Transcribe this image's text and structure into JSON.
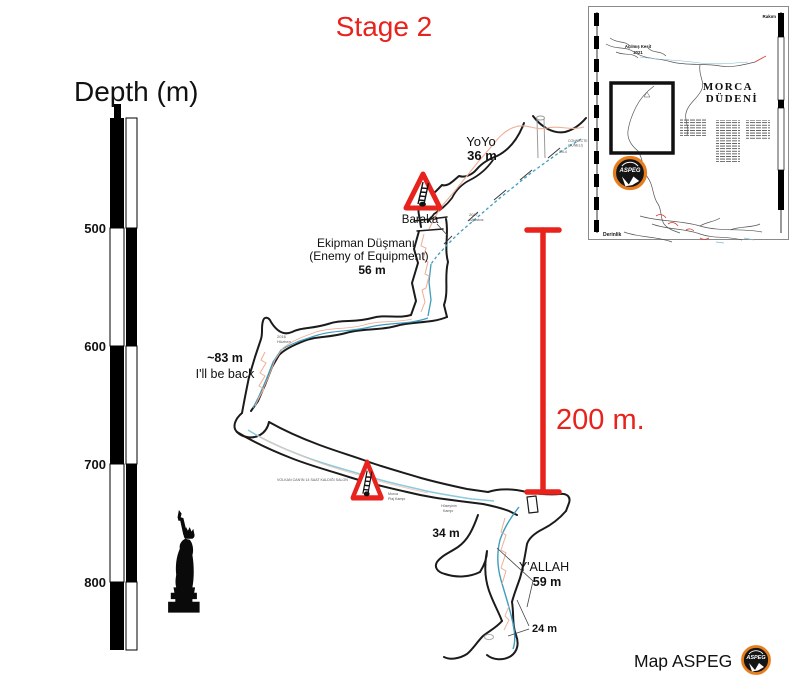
{
  "title": {
    "text": "Stage 2"
  },
  "colors": {
    "accent_red": "#e8221c",
    "stream_blue": "#3f9dbd",
    "stream_light": "#8ccade",
    "rope_salmon": "#efae96",
    "aspeg_orange": "#e87d1e",
    "ink": "#1b1b1b"
  },
  "depth_scale": {
    "label": "Depth (m)",
    "ticks": [
      "500",
      "600",
      "700",
      "800"
    ]
  },
  "labels": {
    "yoyo_name": "YoYo",
    "yoyo_len": "36 m",
    "baraka": "Baraka",
    "ekipman_l1": "Ekipman Düşmanı",
    "ekipman_l2": "(Enemy of Equipment)",
    "ekipman_len": "56 m",
    "illbeback_len": "~83 m",
    "illbeback_name": "I'll be back",
    "p34": "34 m",
    "yallah_name": "Y'ALLAH",
    "yallah_len": "59 m",
    "p24": "24 m"
  },
  "scale_bar": {
    "label": "200 m."
  },
  "micro_labels": {
    "s1a": "2017",
    "s1b": "Ağustos",
    "s2a": "CONNECTE",
    "s2b": "(TÜNELİ)",
    "s3": "2014",
    "s4a": "2016",
    "s4b": "Hüzhen",
    "salon": "VOLKAN CAN'IN 14 SAAT KALDIĞI SALON",
    "plaj_a": "Morca",
    "plaj_b": "Plaj Kampı",
    "huseyin_a": "Hüseyinin",
    "huseyin_b": "Kampı"
  },
  "inset": {
    "title_l1": "MORCA",
    "title_l2": "DÜDENİ",
    "corner_top_right": "Rakım",
    "corner_bottom_left": "Derinlik",
    "note_l1": "Açılmış Kesit",
    "note_l2": "2021"
  },
  "credit": {
    "text": "Map ASPEG",
    "logo_text": "ASPEG"
  }
}
